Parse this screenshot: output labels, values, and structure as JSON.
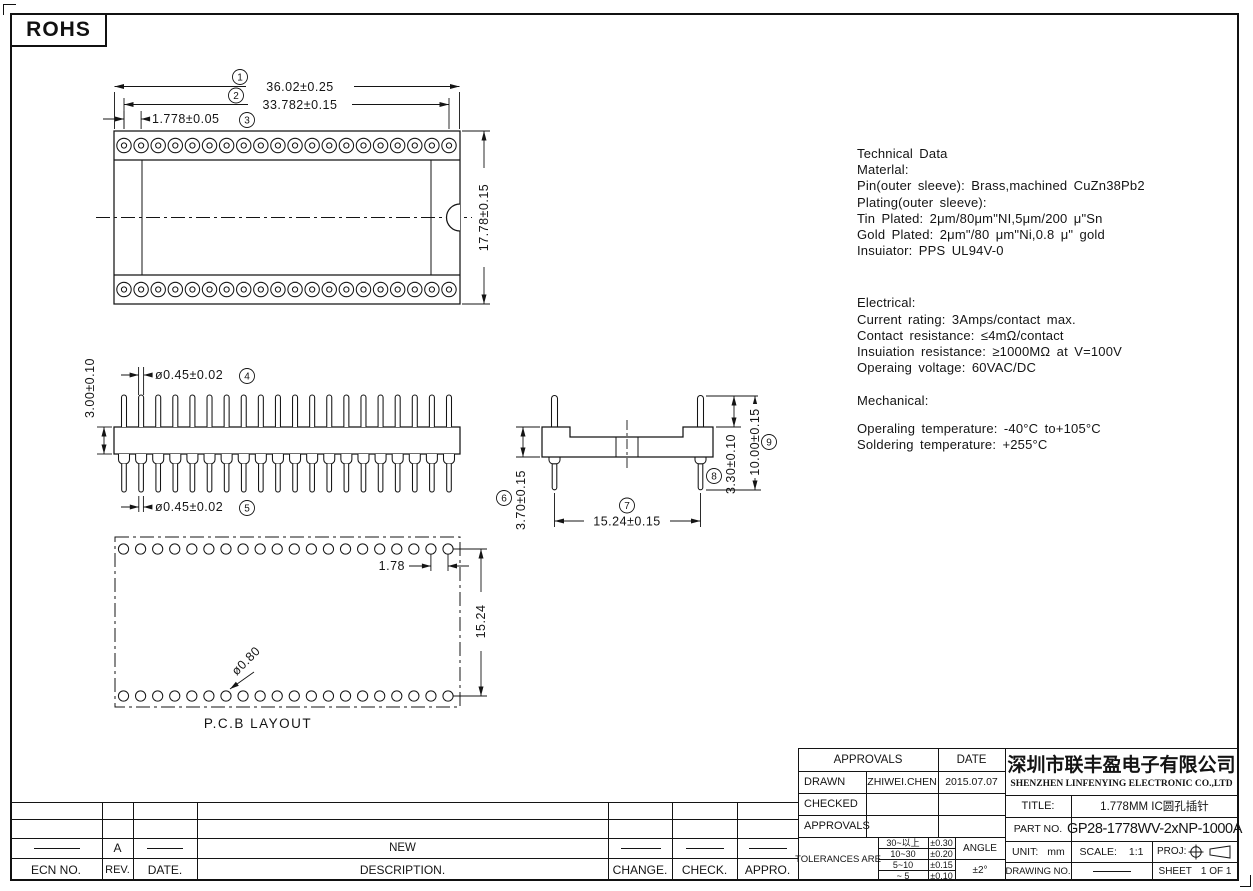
{
  "rohs_label": "ROHS",
  "tech": {
    "block1": [
      "Technical Data",
      "Materlal:",
      "Pin(outer sleeve): Brass,machined CuZn38Pb2",
      "Plating(outer sleeve):",
      "Tin Plated: 2μm/80μm\"NI,5μm/200 μ\"Sn",
      "Gold Plated: 2μm\"/80 μm\"Ni,0.8 μ\" gold",
      "Insuiator: PPS UL94V-0"
    ],
    "block2": [
      "Electrical:",
      "Current rating: 3Amps/contact max.",
      "Contact resistance: ≤4mΩ/contact",
      "Insuiation resistance: ≥1000MΩ at V=100V",
      "Operaing voltage: 60VAC/DC"
    ],
    "block3": [
      "Mechanical:"
    ],
    "block4": [
      "Operaling temperature: -40°C  to+105°C",
      "Soldering temperature: +255°C"
    ]
  },
  "dims": {
    "overall_width": "36.02±0.25",
    "pin_span": "33.782±0.15",
    "pitch": "1.778±0.05",
    "body_height_top": "17.78±0.15",
    "pin_dia_top": "ø0.45±0.02",
    "pin_dia_bottom": "ø0.45±0.02",
    "insulator_height": "3.00±0.10",
    "tail_length": "3.70±0.15",
    "row_spacing": "15.24±0.15",
    "top_pin_length": "3.30±0.10",
    "total_height": "10.00±0.15",
    "pcb_pitch": "1.78",
    "pcb_row": "15.24",
    "pcb_hole": "ø0.80",
    "pcb_label": "P.C.B LAYOUT"
  },
  "callouts": [
    "1",
    "2",
    "3",
    "4",
    "5",
    "6",
    "7",
    "8",
    "9"
  ],
  "titleblock": {
    "approvals_header": "APPROVALS",
    "date_header": "DATE",
    "drawn_label": "DRAWN",
    "drawn_name": "ZHIWEI.CHEN",
    "drawn_date": "2015.07.07",
    "checked_label": "CHECKED",
    "approvals_label": "APPROVALS",
    "tolerances_label": "TOLERANCES ARE",
    "tolerances": [
      [
        "30~以上",
        "±0.30"
      ],
      [
        "10~30",
        "±0.20"
      ],
      [
        "5~10",
        "±0.15"
      ],
      [
        "~ 5",
        "±0.10"
      ]
    ],
    "angle_label": "ANGLE",
    "angle_value": "±2°",
    "company_cn": "深圳市联丰盈电子有限公司",
    "company_en": "SHENZHEN LINFENYING ELECTRONIC CO.,LTD",
    "title_label": "TITLE:",
    "title_value": "1.778MM IC圆孔插针",
    "part_label": "PART NO.",
    "part_value": "GP28-1778WV-2xNP-1000A",
    "unit_label": "UNIT:",
    "unit_value": "mm",
    "scale_label": "SCALE:",
    "scale_value": "1:1",
    "proj_label": "PROJ:",
    "drawing_label": "DRAWING NO.",
    "sheet_label": "SHEET",
    "sheet_value": "1 OF 1"
  },
  "revision": {
    "headers": [
      "ECN NO.",
      "REV.",
      "DATE.",
      "DESCRIPTION.",
      "CHANGE.",
      "CHECK.",
      "APPRO."
    ],
    "row": {
      "rev": "A",
      "description": "NEW"
    }
  }
}
